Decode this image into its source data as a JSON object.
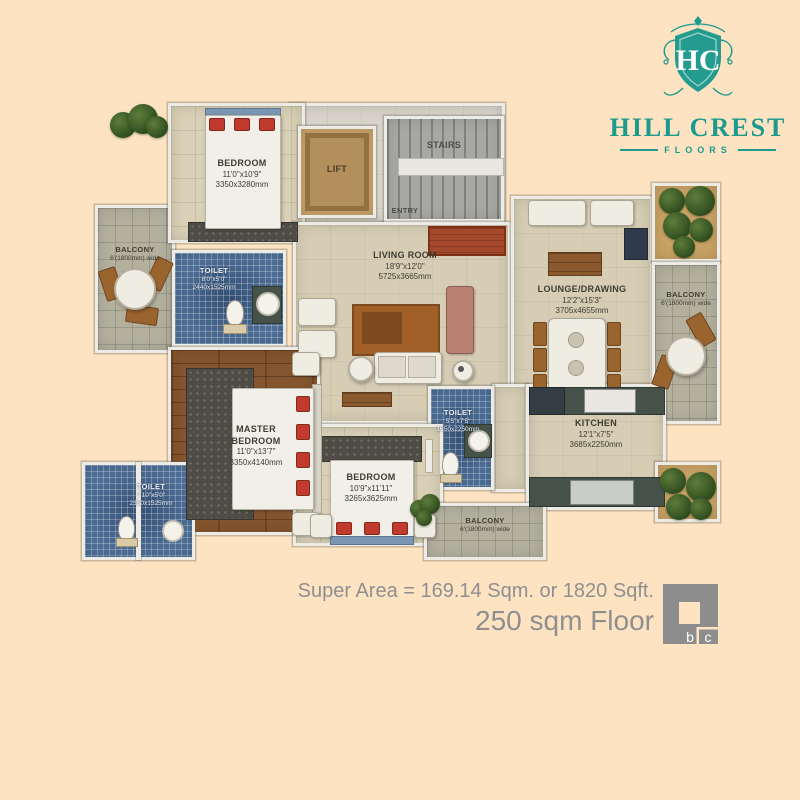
{
  "logo": {
    "monogram": "HC",
    "name": "HILL CREST",
    "subtitle": "FLOORS",
    "teal": "#1c9a8e"
  },
  "rooms": {
    "bedroom_top": {
      "name": "BEDROOM",
      "dim_ft": "11'0\"x10'9\"",
      "dim_mm": "3350x3280mm"
    },
    "lift": {
      "name": "LIFT"
    },
    "stairs": {
      "name": "STAIRS"
    },
    "entry": {
      "name": "ENTRY"
    },
    "living": {
      "name": "LIVING ROOM",
      "dim_ft": "18'9\"x12'0\"",
      "dim_mm": "5725x3665mm"
    },
    "lounge": {
      "name": "LOUNGE/DRAWING",
      "dim_ft": "12'2\"x15'3\"",
      "dim_mm": "3705x4655mm"
    },
    "master": {
      "name": "MASTER BEDROOM",
      "dim_ft": "11'0\"x13'7\"",
      "dim_mm": "3350x4140mm"
    },
    "bedroom_bottom": {
      "name": "BEDROOM",
      "dim_ft": "10'9\"x11'11\"",
      "dim_mm": "3265x3625mm"
    },
    "kitchen": {
      "name": "KITCHEN",
      "dim_ft": "12'1\"x7'5\"",
      "dim_mm": "3685x2250mm"
    },
    "toilet_top": {
      "name": "TOILET",
      "dim_ft": "8'0\"x5'0\"",
      "dim_mm": "2440x1525mm"
    },
    "toilet_mid": {
      "name": "TOILET",
      "dim_ft": "5'5\"x7'5\"",
      "dim_mm": "1650x2250mm"
    },
    "toilet_bottom": {
      "name": "TOILET",
      "dim_ft": "7'10\"x5'0\"",
      "dim_mm": "2390x1525mm"
    },
    "balcony_left": {
      "name": "BALCONY",
      "width_note": "6'(1800mm) wide"
    },
    "balcony_right": {
      "name": "BALCONY",
      "width_note": "6'(1800mm) wide"
    },
    "balcony_bottom": {
      "name": "BALCONY",
      "width_note": "6'(1800mm) wide"
    }
  },
  "footer": {
    "super_area": "Super Area = 169.14 Sqm. or 1820 Sqft.",
    "floor_label": "250 sqm Floor",
    "logo_letter_b": "b",
    "logo_letter_c": "c"
  },
  "colors": {
    "background": "#fde3c2",
    "brand_teal": "#1c9a8e",
    "footer_gray": "#8f8f8f",
    "mosaic_blue": "#4e6f97",
    "wood_brown": "#84552e"
  }
}
